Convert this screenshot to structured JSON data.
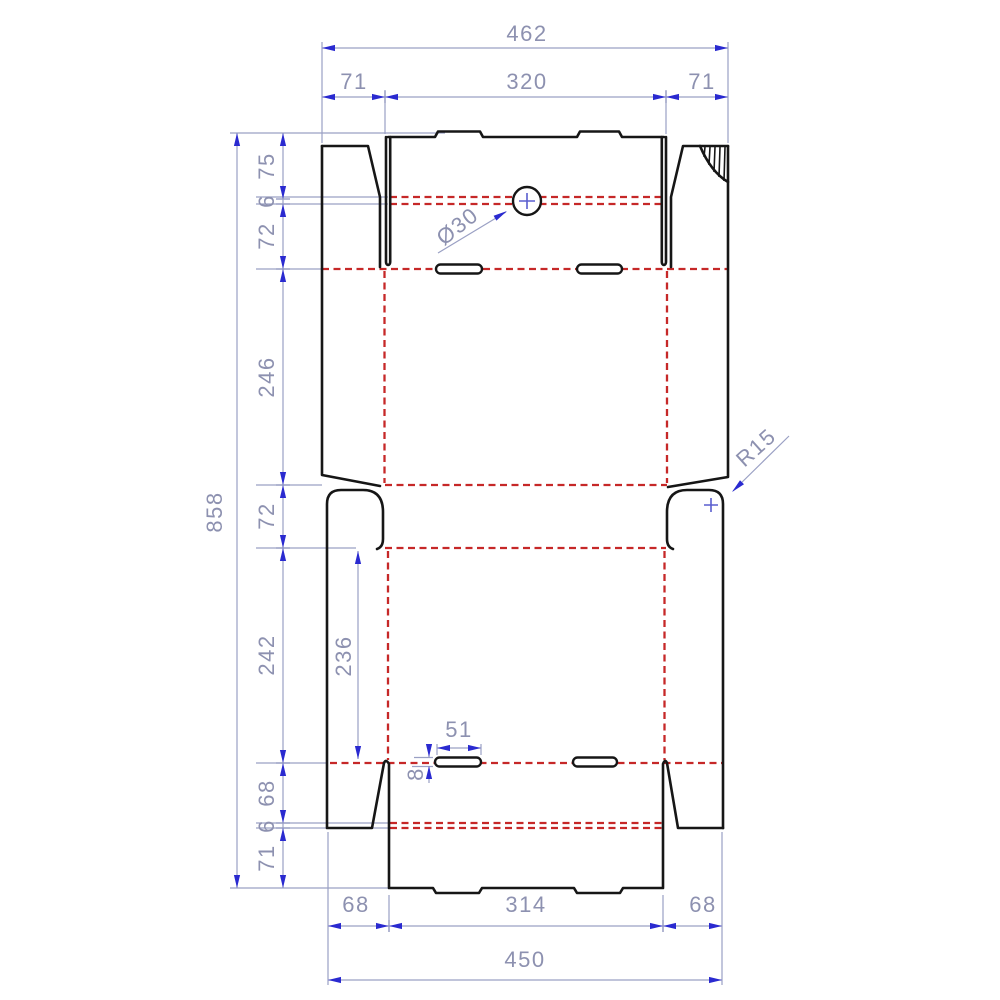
{
  "drawing": {
    "type": "box dieline technical drawing",
    "dimensions": {
      "top": {
        "total": "462",
        "segments": [
          "71",
          "320",
          "71"
        ]
      },
      "left": {
        "total": "858",
        "segments": [
          "75",
          "6",
          "72",
          "246",
          "72",
          "242",
          "68",
          "6",
          "71"
        ]
      },
      "bottom": {
        "total": "450",
        "segments": [
          "68",
          "314",
          "68"
        ]
      },
      "inner": {
        "panel_height": "236",
        "slot_width": "51",
        "slot_height": "8"
      },
      "annotations": {
        "hole_diameter": "Ø30",
        "corner_radius": "R15"
      }
    },
    "colors": {
      "cut_line": "#161616",
      "crease_line": "#c62828",
      "dimension_line": "#9aa0c4",
      "dimension_arrow": "#2a2ad0",
      "dimension_text": "#8d91b0",
      "background": "#ffffff"
    }
  }
}
